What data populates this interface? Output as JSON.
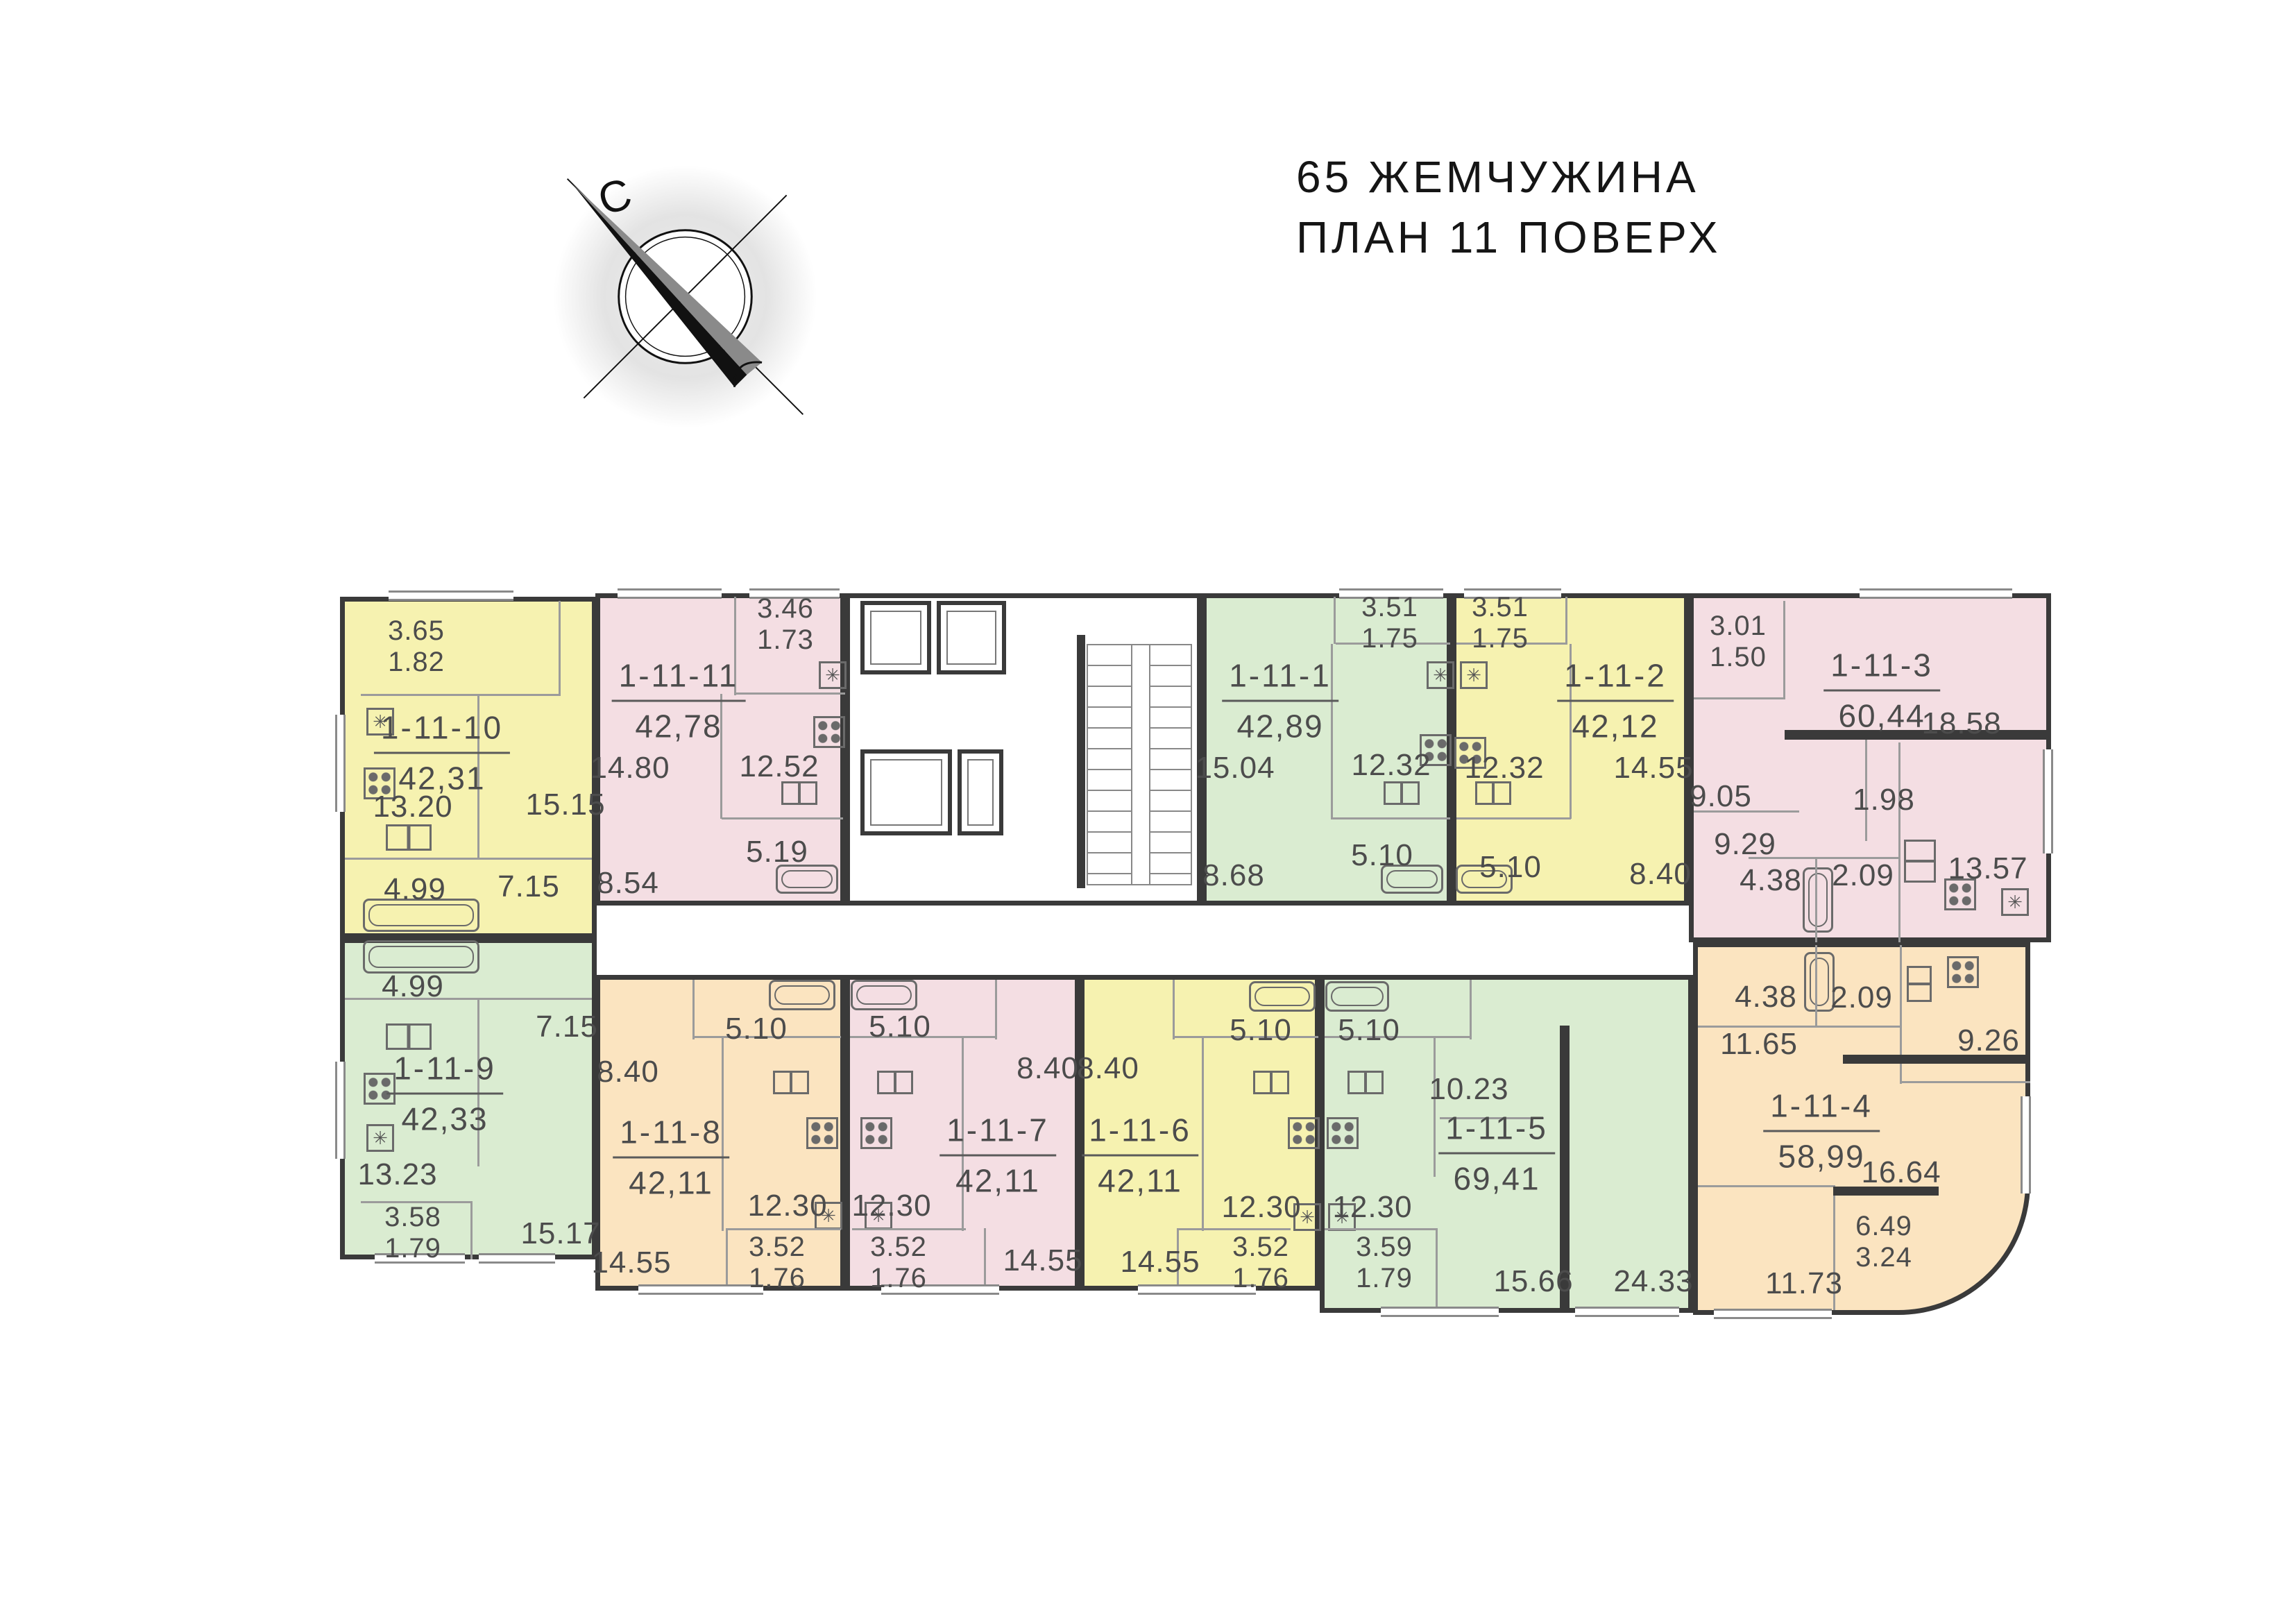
{
  "title": {
    "line1": "65 ЖЕМЧУЖИНА",
    "line2": "ПЛАН 11 ПОВЕРХ"
  },
  "compass": {
    "north_label": "С"
  },
  "colors": {
    "yellow": "#f6f2b0",
    "pink": "#f4dee3",
    "green": "#daecd1",
    "orange": "#fbe4c0",
    "walls": "#3a3a3a"
  },
  "apartments": [
    {
      "id": "1-11-10",
      "total_area": "42,31",
      "color": "yellow",
      "rooms": [
        {
          "type": "balcony",
          "area": "3.65",
          "reduced": "1.82"
        },
        {
          "type": "kitchen",
          "area": "13.20"
        },
        {
          "type": "room",
          "area": "15.15"
        },
        {
          "type": "hall",
          "area": "7.15"
        },
        {
          "type": "bathroom",
          "area": "4.99"
        }
      ]
    },
    {
      "id": "1-11-11",
      "total_area": "42,78",
      "color": "pink",
      "rooms": [
        {
          "type": "balcony",
          "area": "3.46",
          "reduced": "1.73"
        },
        {
          "type": "room",
          "area": "14.80"
        },
        {
          "type": "kitchen",
          "area": "12.52"
        },
        {
          "type": "bathroom",
          "area": "5.19"
        },
        {
          "type": "hall",
          "area": "8.54"
        }
      ]
    },
    {
      "id": "1-11-1",
      "total_area": "42,89",
      "color": "green",
      "rooms": [
        {
          "type": "balcony",
          "area": "3.51",
          "reduced": "1.75"
        },
        {
          "type": "room",
          "area": "15.04"
        },
        {
          "type": "kitchen",
          "area": "12.32"
        },
        {
          "type": "bathroom",
          "area": "5.10"
        },
        {
          "type": "hall",
          "area": "8.68"
        }
      ]
    },
    {
      "id": "1-11-2",
      "total_area": "42,12",
      "color": "yellow",
      "rooms": [
        {
          "type": "balcony",
          "area": "3.51",
          "reduced": "1.75"
        },
        {
          "type": "kitchen",
          "area": "12.32"
        },
        {
          "type": "room",
          "area": "14.55"
        },
        {
          "type": "bathroom",
          "area": "5.10"
        },
        {
          "type": "hall",
          "area": "8.40"
        }
      ]
    },
    {
      "id": "1-11-3",
      "total_area": "60,44",
      "color": "pink",
      "rooms": [
        {
          "type": "balcony",
          "area": "3.01",
          "reduced": "1.50"
        },
        {
          "type": "room",
          "area": "18.58"
        },
        {
          "type": "room",
          "area": "9.05"
        },
        {
          "type": "hall",
          "area": "9.29"
        },
        {
          "type": "corridor",
          "area": "1.98"
        },
        {
          "type": "bathroom",
          "area": "4.38"
        },
        {
          "type": "wc",
          "area": "2.09"
        },
        {
          "type": "kitchen",
          "area": "13.57"
        }
      ]
    },
    {
      "id": "1-11-9",
      "total_area": "42,33",
      "color": "green",
      "rooms": [
        {
          "type": "bathroom",
          "area": "4.99"
        },
        {
          "type": "hall",
          "area": "7.15"
        },
        {
          "type": "kitchen",
          "area": "13.23"
        },
        {
          "type": "balcony",
          "area": "3.58",
          "reduced": "1.79"
        },
        {
          "type": "room",
          "area": "15.17"
        }
      ]
    },
    {
      "id": "1-11-8",
      "total_area": "42,11",
      "color": "orange",
      "rooms": [
        {
          "type": "bathroom",
          "area": "5.10"
        },
        {
          "type": "hall",
          "area": "8.40"
        },
        {
          "type": "room",
          "area": "14.55"
        },
        {
          "type": "kitchen",
          "area": "12.30"
        },
        {
          "type": "balcony",
          "area": "3.52",
          "reduced": "1.76"
        }
      ]
    },
    {
      "id": "1-11-7",
      "total_area": "42,11",
      "color": "pink",
      "rooms": [
        {
          "type": "bathroom",
          "area": "5.10"
        },
        {
          "type": "hall",
          "area": "8.40"
        },
        {
          "type": "kitchen",
          "area": "12.30"
        },
        {
          "type": "balcony",
          "area": "3.52",
          "reduced": "1.76"
        },
        {
          "type": "room",
          "area": "14.55"
        }
      ]
    },
    {
      "id": "1-11-6",
      "total_area": "42,11",
      "color": "yellow",
      "rooms": [
        {
          "type": "bathroom",
          "area": "5.10"
        },
        {
          "type": "hall",
          "area": "8.40"
        },
        {
          "type": "kitchen",
          "area": "12.30"
        },
        {
          "type": "balcony",
          "area": "3.52",
          "reduced": "1.76"
        },
        {
          "type": "room",
          "area": "14.55"
        }
      ]
    },
    {
      "id": "1-11-5",
      "total_area": "69,41",
      "color": "green",
      "rooms": [
        {
          "type": "bathroom",
          "area": "5.10"
        },
        {
          "type": "hall",
          "area": "10.23"
        },
        {
          "type": "kitchen",
          "area": "12.30"
        },
        {
          "type": "room",
          "area": "15.66"
        },
        {
          "type": "room",
          "area": "24.33"
        },
        {
          "type": "balcony",
          "area": "3.59",
          "reduced": "1.79"
        }
      ]
    },
    {
      "id": "1-11-4",
      "total_area": "58,99",
      "color": "orange",
      "rooms": [
        {
          "type": "bathroom",
          "area": "4.38"
        },
        {
          "type": "wc",
          "area": "2.09"
        },
        {
          "type": "hall",
          "area": "11.65"
        },
        {
          "type": "kitchen",
          "area": "9.26"
        },
        {
          "type": "room",
          "area": "16.64"
        },
        {
          "type": "balcony",
          "area": "6.49",
          "reduced": "3.24"
        },
        {
          "type": "room",
          "area": "11.73"
        }
      ]
    }
  ]
}
